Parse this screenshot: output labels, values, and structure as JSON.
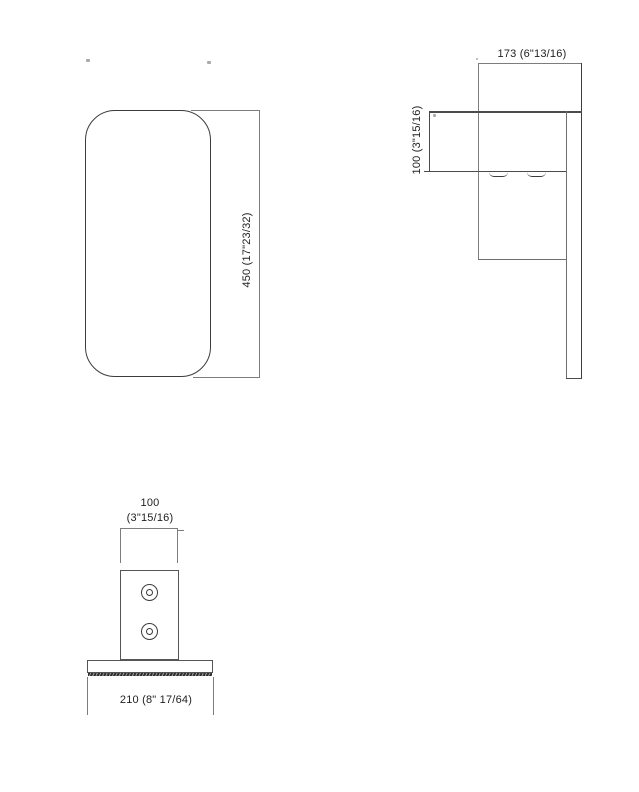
{
  "drawing": {
    "kind": "technical-dimension-drawing",
    "views": {
      "front": {
        "height_dim": "450 (17\"23/32)"
      },
      "side": {
        "depth_dim": "173 (6\"13/16)",
        "thickness_dim": "100 (3\"15/16)"
      },
      "bottom": {
        "width_dim_value": "100",
        "width_dim_inches": "(3\"15/16)",
        "base_dim": "210 (8\" 17/64)"
      }
    },
    "colors": {
      "background": "#ffffff",
      "line": "#6e6e6e",
      "line_dark": "#3c3c3c",
      "dim_line": "#7d7d7d",
      "text": "#1f1f1f"
    }
  }
}
